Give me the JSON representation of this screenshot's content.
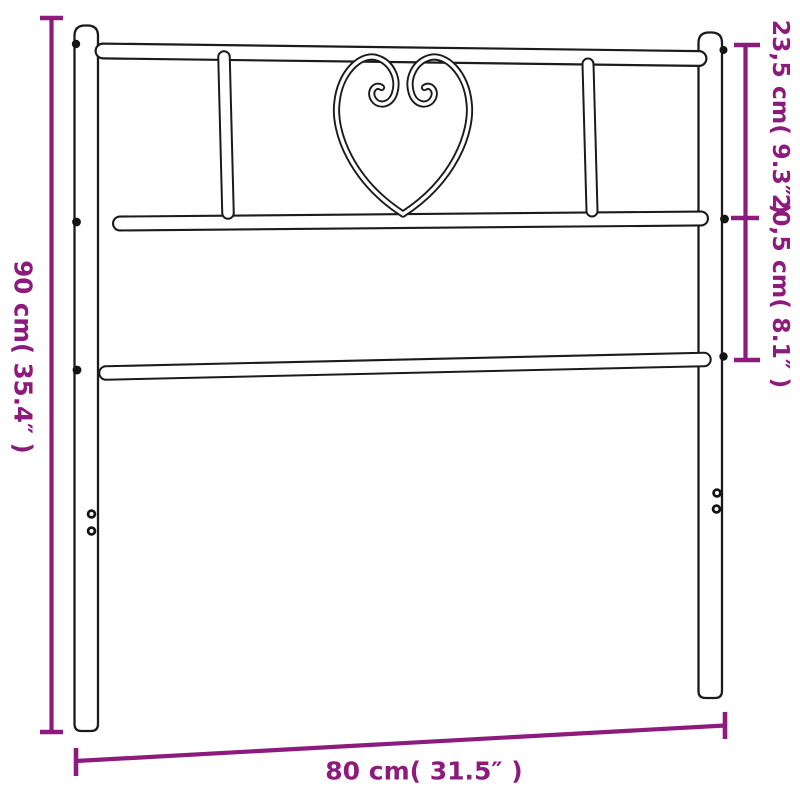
{
  "diagram": {
    "product": "metal headboard with heart ornament",
    "background_color": "#ffffff",
    "outline_color": "#1b1b1b",
    "accent_color": "#8d1b7d",
    "dimensions": {
      "height": {
        "label": "90 cm( 35.4″ )",
        "value_cm": 90,
        "value_in": 35.4
      },
      "upper_section": {
        "label": "23,5 cm( 9.3″ )",
        "value_cm": 23.5,
        "value_in": 9.3
      },
      "middle_section": {
        "label": "20,5 cm( 8.1″ )",
        "value_cm": 20.5,
        "value_in": 8.1
      },
      "width": {
        "label": "80 cm( 31.5″ )",
        "value_cm": 80,
        "value_in": 31.5
      }
    }
  }
}
